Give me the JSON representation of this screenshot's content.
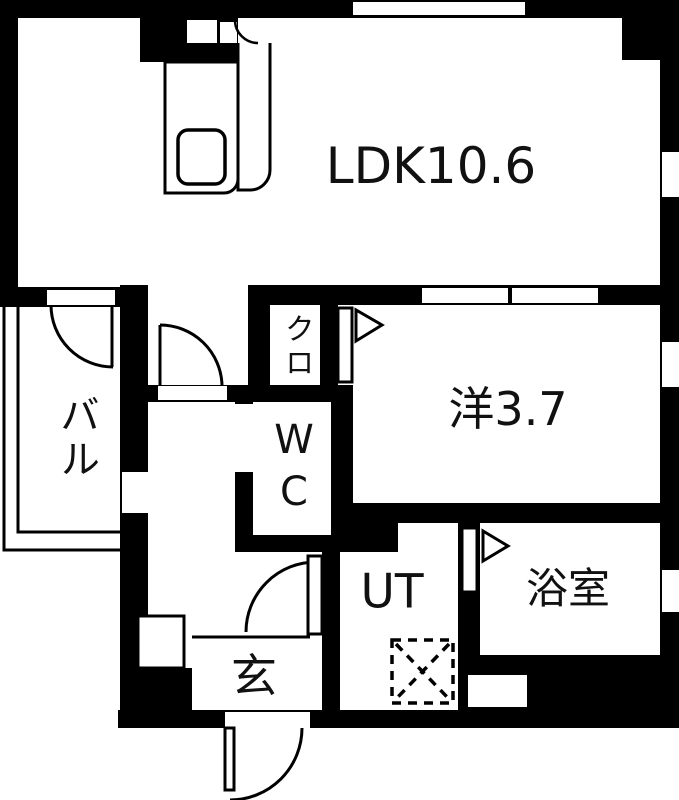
{
  "plan_title": "apartment-floor-plan",
  "colors": {
    "wall": "#000000",
    "floor": "#ffffff",
    "line": "#000000"
  },
  "rooms": {
    "ldk": "LDK10.6",
    "western_room": "洋3.7",
    "balcony": "バル",
    "closet": "クロ",
    "toilet": "WC",
    "utility": "UT",
    "bathroom": "浴室",
    "entrance": "玄"
  }
}
